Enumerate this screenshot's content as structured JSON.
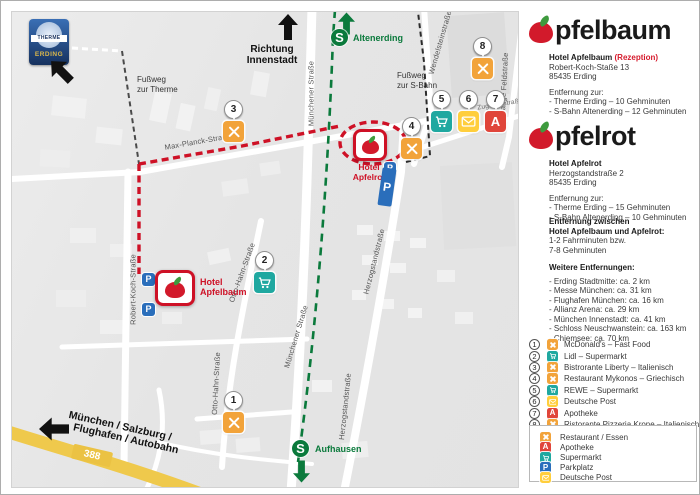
{
  "icons": {
    "apotheke_letter": "A",
    "parkplatz_letter": "P",
    "sbahn_letter": "S"
  },
  "colors": {
    "brand_red": "#CE1126",
    "restaurant_orange": "#F2A33A",
    "supermarkt_teal": "#1FA8A0",
    "post_yellow": "#FFCE3C",
    "apotheke_red": "#E0453A",
    "parkplatz_blue": "#2A6EBB",
    "sbahn_green": "#0B7A3C",
    "road_yellow": "#EFC94C"
  },
  "map": {
    "therme_logo": {
      "top": "THERME",
      "bottom": "ERDING"
    },
    "direction_innenstadt": {
      "line1": "Richtung",
      "line2": "Innenstadt"
    },
    "autobahn_label": {
      "line1": "München / Salzburg /",
      "line2": "Flughafen / Autobahn"
    },
    "road_number": "388",
    "sbahn": {
      "station_top": "Altenerding",
      "station_bottom": "Aufhausen"
    },
    "footpaths": {
      "therme": {
        "line1": "Fußweg",
        "line2": "zur Therme"
      },
      "sbahn": {
        "line1": "Fußweg",
        "line2": "zur S-Bahn"
      }
    },
    "hotels": {
      "apfelbaum": {
        "line1": "Hotel",
        "line2": "Apfelbaum"
      },
      "apfelrot": {
        "line1": "Hotel",
        "line2": "Apfelrot"
      }
    },
    "streets": [
      "Max-Planck-Straße",
      "Robert-Koch-Straße",
      "Otto-Hahn-Straße",
      "Otto-Hahn-Straße",
      "Münchener Straße",
      "Münchener Straße",
      "Herzogstandstraße",
      "Herzogstandstraße",
      "Wendelsteinstraße",
      "Lange Feldstraße",
      "Zugspitzstraße"
    ],
    "markers": [
      {
        "num": "1",
        "type": "restaurant"
      },
      {
        "num": "2",
        "type": "supermarkt"
      },
      {
        "num": "3",
        "type": "restaurant"
      },
      {
        "num": "4",
        "type": "restaurant"
      },
      {
        "num": "5",
        "type": "supermarkt"
      },
      {
        "num": "6",
        "type": "post"
      },
      {
        "num": "7",
        "type": "apotheke"
      },
      {
        "num": "8",
        "type": "restaurant"
      }
    ]
  },
  "sidebar": {
    "apfelbaum": {
      "logo_text": "pfelbaum",
      "name": "Hotel Apfelbaum",
      "name_suffix": "(Rezeption)",
      "address1": "Robert-Koch-Staße 13",
      "address2": "85435 Erding",
      "distances_heading": "Entfernung zur:",
      "distances": [
        "- Therme Erding – 10 Gehminuten",
        "- S-Bahn Altenerding – 12 Gehminuten"
      ]
    },
    "apfelrot": {
      "logo_text": "pfelrot",
      "name": "Hotel Apfelrot",
      "address1": "Herzogstandstraße 2",
      "address2": "85435 Erding",
      "distances_heading": "Entfernung zur:",
      "distances": [
        "- Therme Erding – 15 Gehminuten",
        "- S-Bahn Altenerding – 10 Gehminuten"
      ]
    },
    "between": {
      "heading1": "Entfernung zwischen",
      "heading2": "Hotel Apfelbaum und Apfelrot:",
      "line1": "1-2 Fahrminuten bzw.",
      "line2": "7-8 Gehminuten"
    },
    "more_distances": {
      "heading": "Weitere Entfernungen:",
      "items": [
        "- Erding Stadtmitte: ca. 2 km",
        "- Messe München: ca. 31 km",
        "- Flughafen München: ca. 16 km",
        "- Allianz Arena: ca. 29 km",
        "- München Innenstadt: ca. 41 km",
        "- Schloss Neuschwanstein: ca. 163 km",
        "- Chiemsee: ca. 70 km"
      ]
    },
    "numbered_legend": [
      {
        "num": "1",
        "type": "restaurant",
        "label": "McDonald's – Fast Food"
      },
      {
        "num": "2",
        "type": "supermarkt",
        "label": "Lidl – Supermarkt"
      },
      {
        "num": "3",
        "type": "restaurant",
        "label": "Bistrorante Liberty – Italienisch"
      },
      {
        "num": "4",
        "type": "restaurant",
        "label": "Restaurant Mykonos – Griechisch"
      },
      {
        "num": "5",
        "type": "supermarkt",
        "label": "REWE – Supermarkt"
      },
      {
        "num": "6",
        "type": "post",
        "label": "Deutsche Post"
      },
      {
        "num": "7",
        "type": "apotheke",
        "label": "Apotheke"
      },
      {
        "num": "8",
        "type": "restaurant",
        "label": "Ristorante Pizzeria Krone – Italienisch"
      }
    ],
    "type_legend": [
      {
        "type": "restaurant",
        "label": "Restaurant / Essen"
      },
      {
        "type": "apotheke",
        "label": "Apotheke"
      },
      {
        "type": "supermarkt",
        "label": "Supermarkt"
      },
      {
        "type": "parkplatz",
        "label": "Parkplatz"
      },
      {
        "type": "post",
        "label": "Deutsche Post"
      }
    ]
  }
}
